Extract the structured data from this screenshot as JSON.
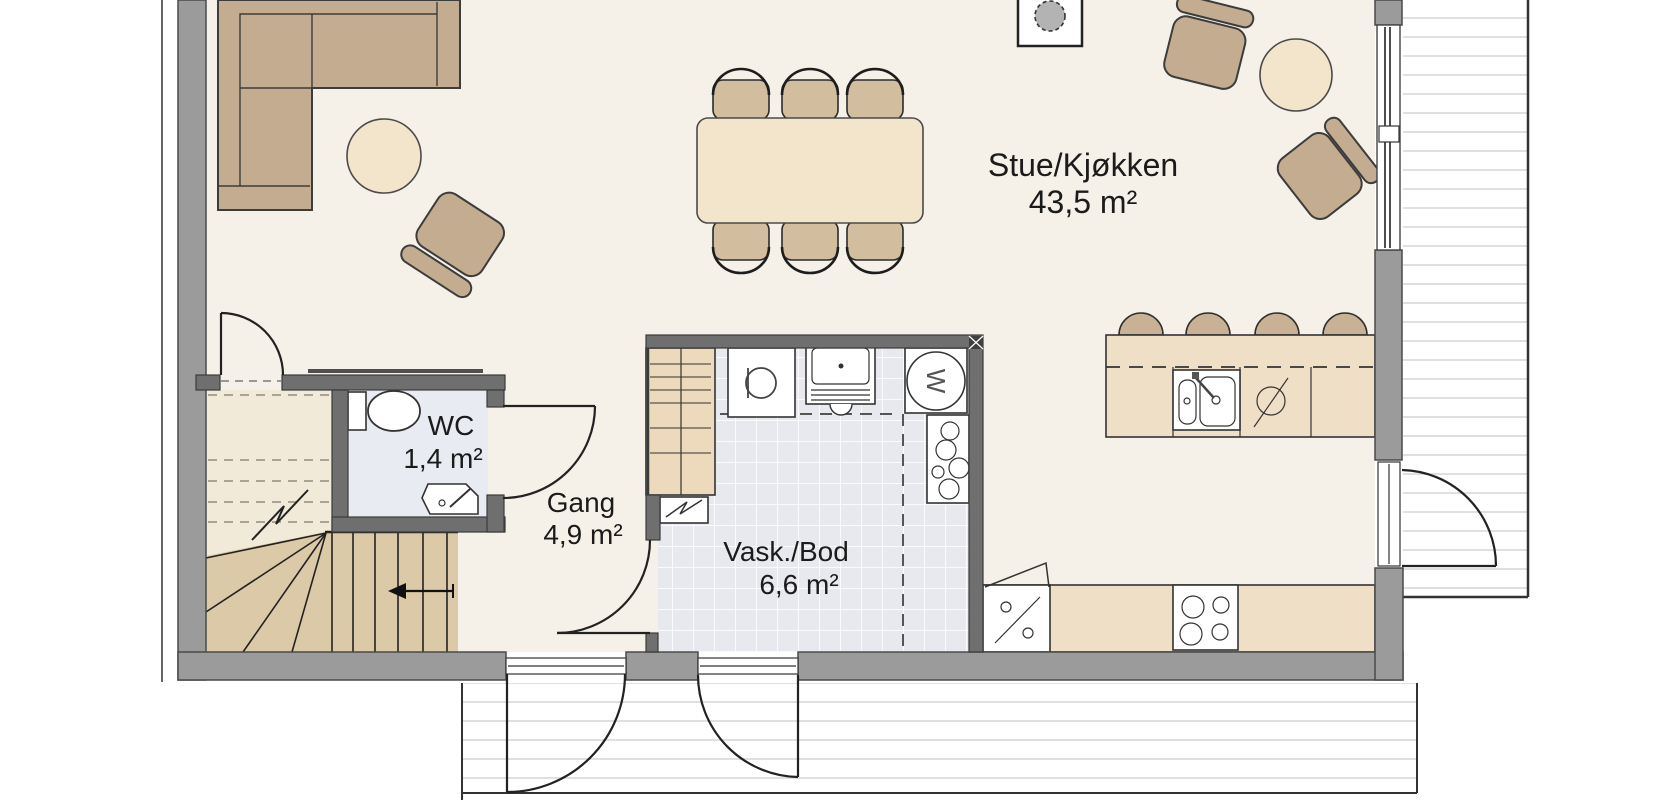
{
  "plan_type": "floor-plan",
  "rooms": [
    {
      "id": "stue",
      "name": "Stue/Kjøkken",
      "area": "43,5 m²"
    },
    {
      "id": "wc",
      "name": "WC",
      "area": "1,4 m²"
    },
    {
      "id": "gang",
      "name": "Gang",
      "area": "4,9 m²"
    },
    {
      "id": "vask",
      "name": "Vask./Bod",
      "area": "6,6 m²"
    }
  ],
  "appliances": {
    "washing_machine_label": "W"
  },
  "colors": {
    "wall_exterior": "#9b9b9b",
    "wall_interior": "#6f6f6f",
    "floor": "#f6f1e8",
    "floor_wc": "#e9ebf2",
    "floor_laundry": "#e8e9ef",
    "furniture_tan": "#c3ac90",
    "furniture_light": "#f3e4cc",
    "dining_chair": "#d3bd9f",
    "counter": "#f0dfc7",
    "stool": "#c8b194",
    "stair_tread": "#dcc9a7",
    "stair_upper": "#f2ead8",
    "deck_line": "#dcdcdc",
    "fireplace_gray": "#b3b3b3",
    "text": "#1b1b1b"
  }
}
